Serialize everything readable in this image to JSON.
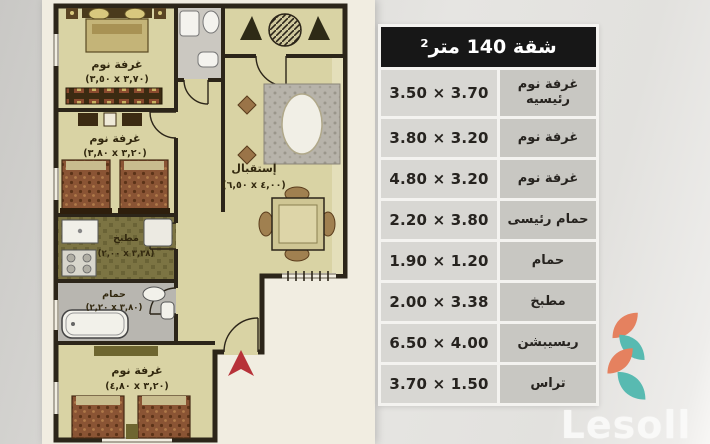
{
  "table": {
    "title": "شقة 140 متر²",
    "rows": [
      {
        "value": "3.50 × 3.70",
        "label": "غرفة نوم رئيسيه"
      },
      {
        "value": "3.80 × 3.20",
        "label": "غرفة نوم"
      },
      {
        "value": "4.80 × 3.20",
        "label": "غرفة نوم"
      },
      {
        "value": "2.20 × 3.80",
        "label": "حمام رئيسى"
      },
      {
        "value": "1.90 × 1.20",
        "label": "حمام"
      },
      {
        "value": "2.00 × 3.38",
        "label": "مطبخ"
      },
      {
        "value": "6.50 × 4.00",
        "label": "ريسيبشن"
      },
      {
        "value": "3.70 × 1.50",
        "label": "تراس"
      }
    ]
  },
  "floorplan": {
    "rooms": [
      {
        "name": "غرفة نوم",
        "dims": "(٣,٥٠ x ٣,٧٠)"
      },
      {
        "name": "غرفة نوم",
        "dims": "(٣,٨٠ x ٣,٢٠)"
      },
      {
        "name": "مطبخ",
        "dims": "(٢,٠٠ x ٣,٣٨)"
      },
      {
        "name": "حمام",
        "dims": "(٢,٢٠ x ٣,٨٠)"
      },
      {
        "name": "غرفة نوم",
        "dims": "(٤,٨٠ x ٣,٢٠)"
      },
      {
        "name": "إستقبال",
        "dims": "(٦,٥٠ x ٤,٠٠)"
      }
    ]
  },
  "logo": {
    "text": "Lesoll",
    "colors": {
      "orange": "#e5815f",
      "teal": "#58bab1"
    }
  }
}
